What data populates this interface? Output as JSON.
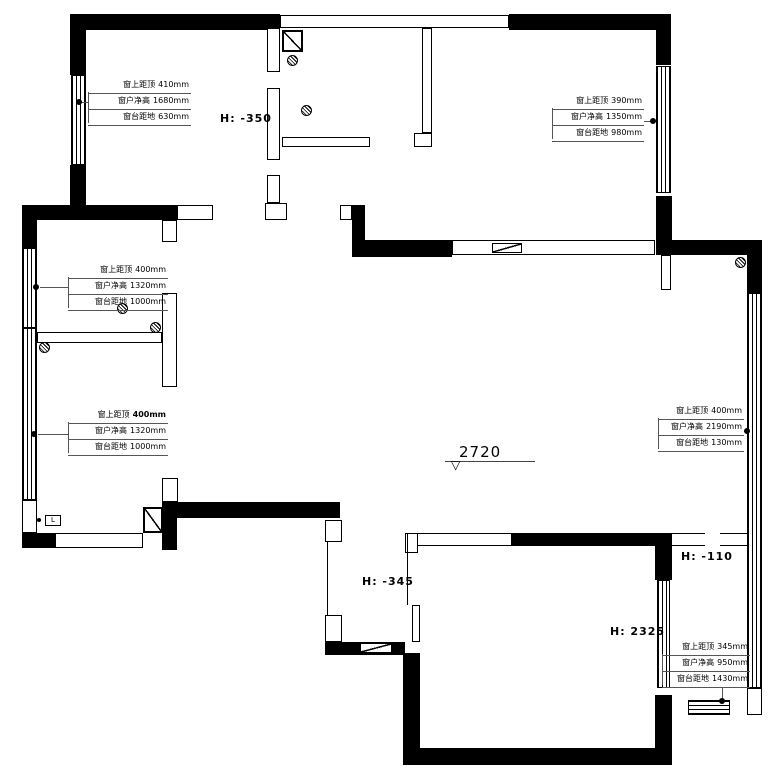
{
  "annotations": [
    {
      "id": "top-left-window",
      "rows": [
        {
          "label": "窗上距顶",
          "value": "410mm"
        },
        {
          "label": "窗户净高",
          "value": "1680mm"
        },
        {
          "label": "窗台距地",
          "value": "630mm"
        }
      ]
    },
    {
      "id": "top-right-window",
      "rows": [
        {
          "label": "窗上距顶",
          "value": "390mm"
        },
        {
          "label": "窗户净高",
          "value": "1350mm"
        },
        {
          "label": "窗台距地",
          "value": "980mm"
        }
      ]
    },
    {
      "id": "left-middle-window",
      "rows": [
        {
          "label": "窗上距顶",
          "value": "400mm"
        },
        {
          "label": "窗户净高",
          "value": "1320mm"
        },
        {
          "label": "窗台距地",
          "value": "1000mm"
        }
      ]
    },
    {
      "id": "left-bottom-window",
      "rows": [
        {
          "label": "窗上距顶",
          "value": "400mm"
        },
        {
          "label": "窗户净高",
          "value": "1320mm"
        },
        {
          "label": "窗台距地",
          "value": "1000mm"
        }
      ]
    },
    {
      "id": "right-middle-window",
      "rows": [
        {
          "label": "窗上距顶",
          "value": "400mm"
        },
        {
          "label": "窗户净高",
          "value": "2190mm"
        },
        {
          "label": "窗台距地",
          "value": "130mm"
        }
      ]
    },
    {
      "id": "bottom-right-window",
      "rows": [
        {
          "label": "窗上距顶",
          "value": "345mm"
        },
        {
          "label": "窗户净高",
          "value": "950mm"
        },
        {
          "label": "窗台距地",
          "value": "1430mm"
        }
      ]
    }
  ],
  "height_labels": [
    {
      "text": "H: -350"
    },
    {
      "text": "H: -345"
    },
    {
      "text": "H: -110"
    },
    {
      "text": "H: 2325"
    }
  ],
  "level_marker": {
    "value": "2720",
    "triangle": "▽"
  },
  "icons": {
    "gas_meter": "L"
  },
  "colors": {
    "wall": "#000000",
    "annotation_line": "#555555",
    "background": "#ffffff"
  }
}
